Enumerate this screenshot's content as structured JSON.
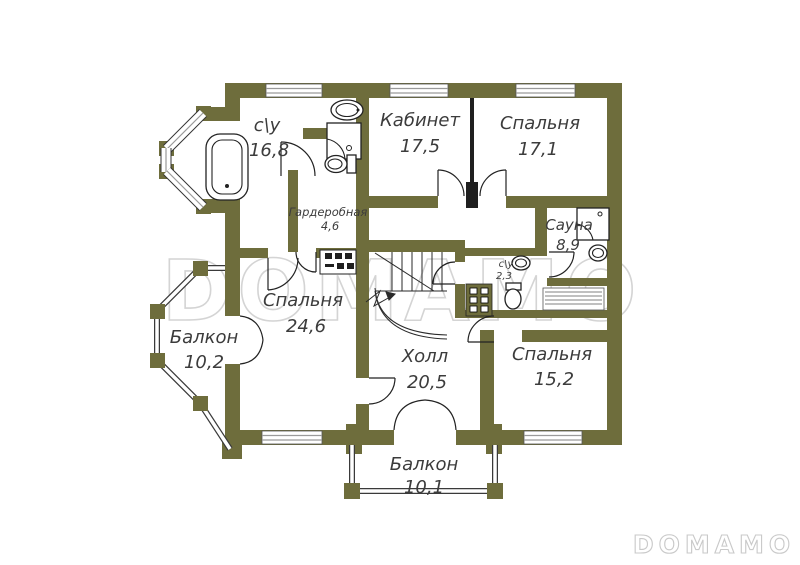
{
  "watermarks": {
    "center": "DOMAMO",
    "corner": "DOMAMO"
  },
  "colors": {
    "wall": "#6e6d3c",
    "partition": "#1f1f1f",
    "window_line": "#9a9a9a",
    "label_text": "#3c3c3c",
    "watermark": "#d4d4d4",
    "background": "#ffffff"
  },
  "rooms": [
    {
      "id": "bathroom-main",
      "name": "с\\у",
      "area": "16,8"
    },
    {
      "id": "office",
      "name": "Кабинет",
      "area": "17,5"
    },
    {
      "id": "bedroom-top",
      "name": "Спальня",
      "area": "17,1"
    },
    {
      "id": "wardrobe",
      "name": "Гардеробная",
      "area": "4,6"
    },
    {
      "id": "sauna",
      "name": "Сауна",
      "area": "8,9"
    },
    {
      "id": "bathroom-small",
      "name": "с\\у",
      "area": "2,3"
    },
    {
      "id": "bedroom-left",
      "name": "Спальня",
      "area": "24,6"
    },
    {
      "id": "balcony-left",
      "name": "Балкон",
      "area": "10,2"
    },
    {
      "id": "hall",
      "name": "Холл",
      "area": "20,5"
    },
    {
      "id": "bedroom-right",
      "name": "Спальня",
      "area": "15,2"
    },
    {
      "id": "balcony-bottom",
      "name": "Балкон",
      "area": "10,1"
    }
  ]
}
